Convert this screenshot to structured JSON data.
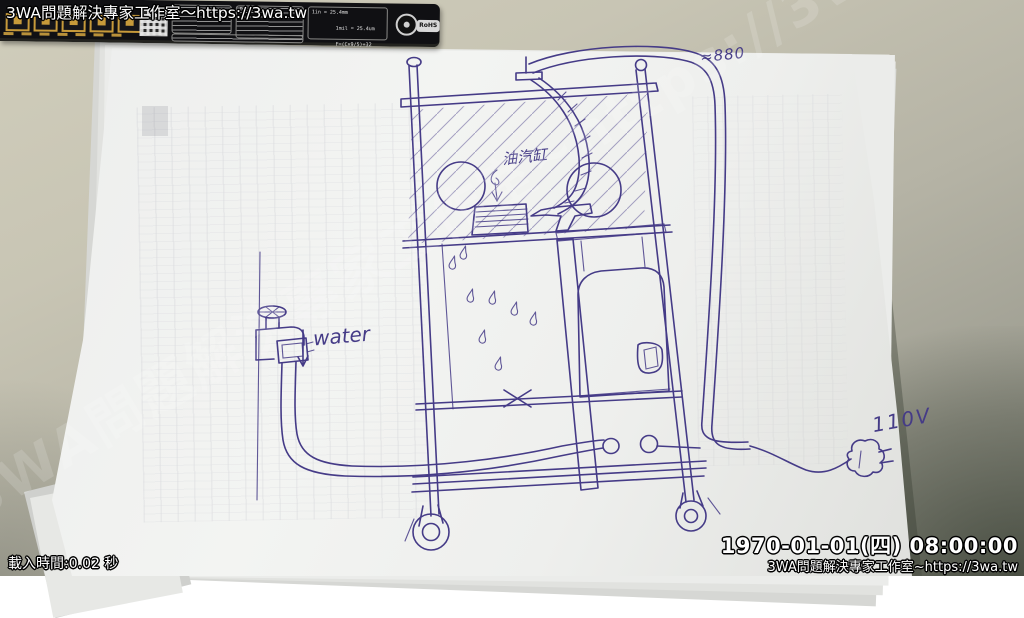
{
  "overlay": {
    "watermark_top": "3WA問題解決專家工作室～https://3wa.tw",
    "watermark_diagonal": "3WA問題解決專家工作室~https://3wa.tw",
    "load_time": "載入時間:0.02 秒",
    "datetime": "1970-01-01(四) 08:00:00",
    "watermark_bottom": "3WA問題解決專家工作室~https://3wa.tw"
  },
  "sketch": {
    "labels": {
      "cylinder": "油汽缸",
      "water": "water",
      "voltage": "110V",
      "dimension": "≈880"
    },
    "ink_color": "#453b87"
  },
  "ruler": {
    "delay_label": "Delay:",
    "conversion_lines": [
      "1in = 25.4mm",
      "1mil = 25.4um",
      "F=(C×9/5)+32"
    ],
    "rohs_label": "RoHS"
  },
  "colors": {
    "desk": "#c6c3b2",
    "desk_shadow": "#20281c",
    "paper": "#f1f2f0",
    "ink": "#453b87",
    "ruler_bg": "#101013",
    "ruler_gold": "#c79a3a",
    "overlay_text": "#ffffff"
  }
}
